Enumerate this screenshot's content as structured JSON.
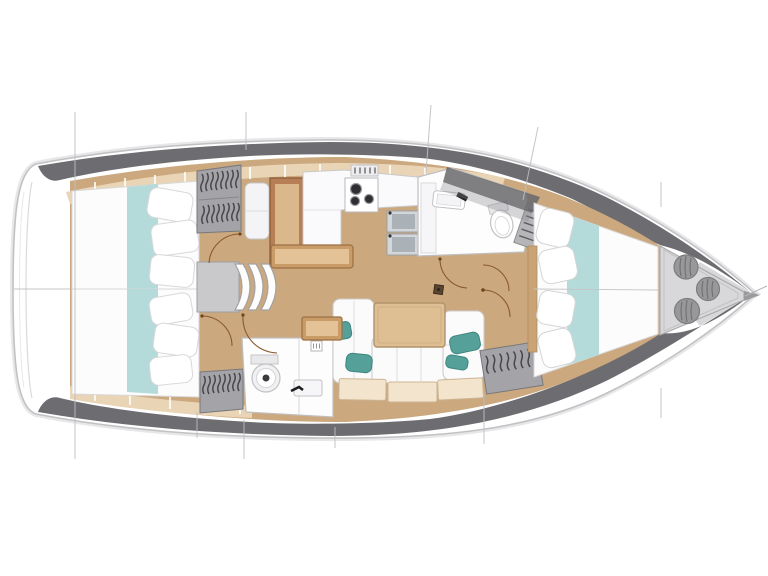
{
  "meta": {
    "description": "Top-down interior layout plan of a sailing yacht, bow pointing right, stern at left",
    "image_type": "boat floor plan drawing"
  },
  "colors": {
    "background": "#ffffff",
    "hull_outline": "#c2c2c4",
    "deck_band": "#6d6d71",
    "floor_wood": "#cba87e",
    "shelf_trim": "#e9d4b5",
    "bedding_white": "#fcfcfd",
    "bedding_stripe_aqua": "#b4dbda",
    "cushion_teal": "#55a19a",
    "wardrobe_gray": "#a4a4a8",
    "clothes_stroke": "#47474b",
    "locker_gray": "#d8d8da",
    "fender_gray": "#98989b",
    "wood_furniture": "#c99b67",
    "table_wood": "#debf94",
    "chart_table_wood": "#b67f55",
    "door_arc_brown": "#8a5a2e",
    "fixture_white": "#fdfdfe",
    "sink_steel": "#d3d7da",
    "burner_dark": "#2f2f33",
    "section_line": "#bfbfc2"
  },
  "regions": {
    "stern_deck": {
      "label": "Stern transom deck"
    },
    "aft_cabin_top": {
      "label": "Aft double cabin, top quarter, with berth and wardrobe"
    },
    "aft_cabin_bottom": {
      "label": "Aft double cabin, bottom quarter, with berth and wardrobe"
    },
    "companionway": {
      "label": "Companionway with three curved steps and landing"
    },
    "nav_station": {
      "label": "Chart table with seat"
    },
    "galley": {
      "label": "Galley with stove and twin sinks"
    },
    "aft_heads": {
      "label": "Aft heads with toilet and washbasin"
    },
    "saloon": {
      "label": "Saloon with U-shaped sofa, teal cushions and dining table"
    },
    "forward_heads": {
      "label": "Forward heads with toilet, washbasin and louvered locker"
    },
    "forward_cabin": {
      "label": "Forward V-berth cabin"
    },
    "bow_locker": {
      "label": "Bow locker with three stowed fenders"
    }
  },
  "counts": {
    "aft_cabins": 2,
    "forward_cabins": 1,
    "heads_compartments": 2,
    "companionway_steps": 3,
    "stove_burners": 3,
    "galley_sinks": 2,
    "bow_fenders": 3,
    "wardrobes": 3,
    "door_swings": 6,
    "section_lines": 12
  }
}
